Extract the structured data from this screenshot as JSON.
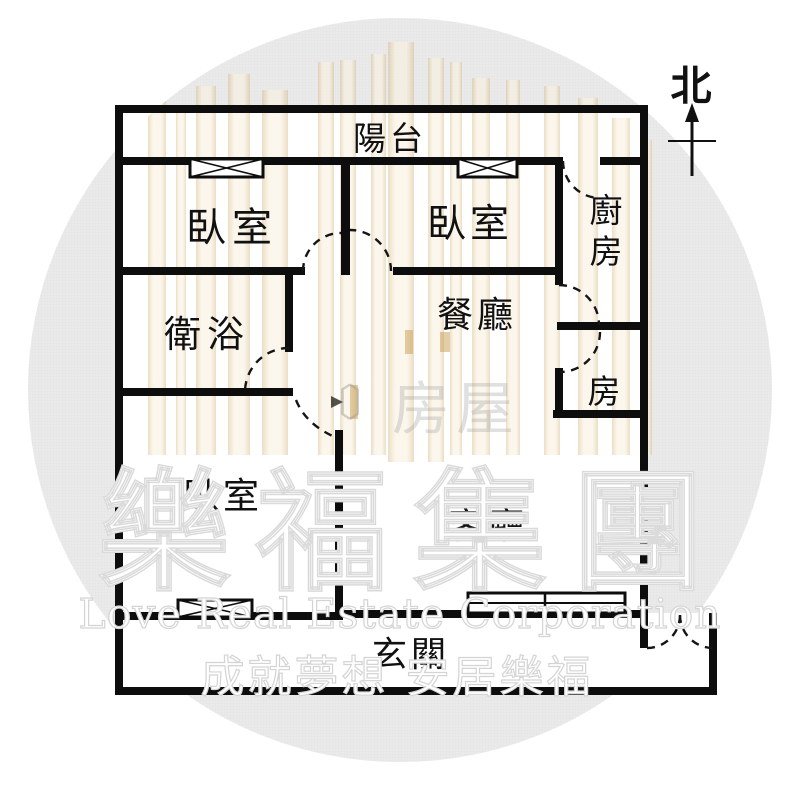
{
  "compass": {
    "label": "北"
  },
  "rooms": [
    {
      "id": "balcony",
      "label": "陽台"
    },
    {
      "id": "bedroom-1",
      "label": "臥室"
    },
    {
      "id": "bedroom-2",
      "label": "臥室"
    },
    {
      "id": "kitchen",
      "label": "廚房"
    },
    {
      "id": "dining",
      "label": "餐廳"
    },
    {
      "id": "room",
      "label": "房"
    },
    {
      "id": "bathroom",
      "label": "衛浴"
    },
    {
      "id": "bedroom-3",
      "label": "臥室"
    },
    {
      "id": "living",
      "label": "客廳"
    },
    {
      "id": "entry",
      "label": "玄關"
    }
  ],
  "watermark": {
    "brand_cjk": "樂福集團",
    "brand_en": "Love Real Estate Corporation",
    "slogan": "成就夢想 安居樂福",
    "center_mark": "房屋",
    "bracket_left": "〔",
    "bracket_right": "〕",
    "circle_color": "#ececec",
    "stripe_color": "#f4e8d0",
    "accent_gold": "#c69a4e",
    "wall_color": "#0d0d0d"
  }
}
